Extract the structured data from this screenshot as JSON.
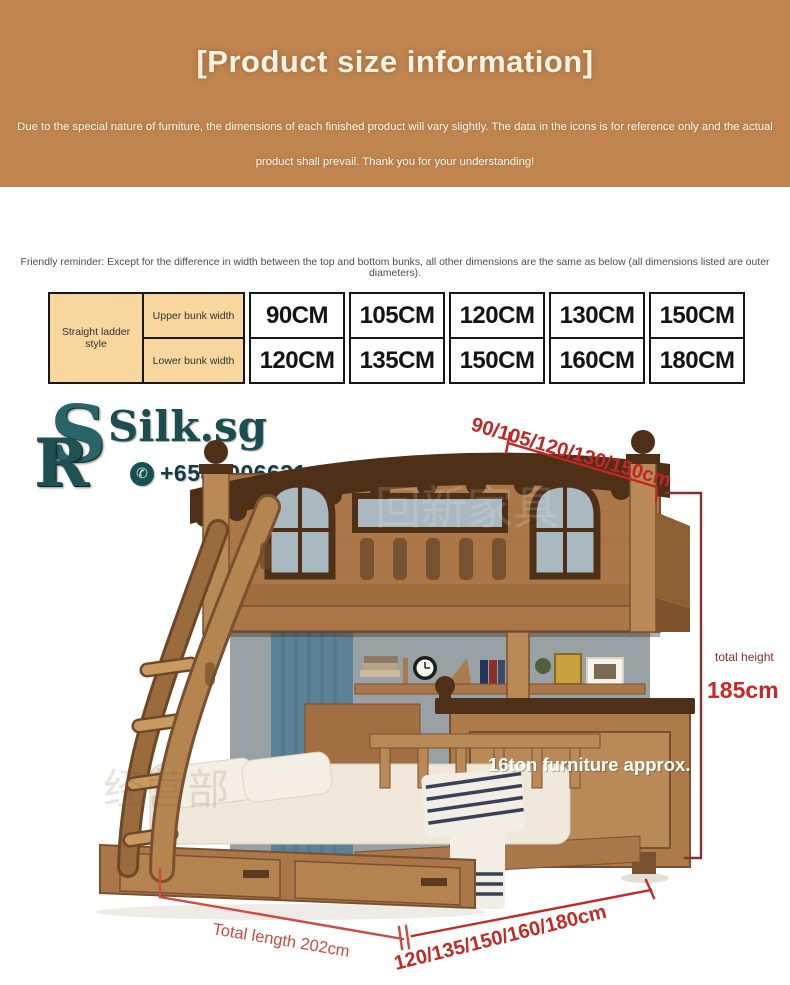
{
  "banner": {
    "title": "[Product size information]",
    "disclaimer_line1": "Due to the special nature of furniture, the dimensions of each finished product will vary slightly. The data in the icons is for reference only and the actual",
    "disclaimer_line2": "product shall prevail. Thank you for your understanding!",
    "bg_color": "#c0854f"
  },
  "reminder": {
    "text": "Friendly reminder: Except for the difference in width between the top and bottom bunks, all other dimensions are the same as below (all dimensions listed are outer diameters)."
  },
  "size_table": {
    "style_label": "Straight ladder style",
    "header_bg": "#f8d79e",
    "rows": [
      {
        "label": "Upper bunk width",
        "values": [
          "90CM",
          "105CM",
          "120CM",
          "130CM",
          "150CM"
        ]
      },
      {
        "label": "Lower bunk width",
        "values": [
          "120CM",
          "135CM",
          "150CM",
          "160CM",
          "180CM"
        ]
      }
    ]
  },
  "logo": {
    "monogram_s": "S",
    "monogram_r": "R",
    "name": "Silk.sg",
    "phone": "+6589006631",
    "whatsapp_glyph": "✆",
    "teal": "#1b4e50"
  },
  "annotations": {
    "top_width": "90/105/120/130/150cm",
    "height_label": "total height",
    "height_value": "185cm",
    "weight_note": "16ton furniture approx.",
    "total_length": "Total length 202cm",
    "bottom_width": "120/135/150/160/180cm",
    "red": "#c42525",
    "dark_red": "#8b2f2f",
    "soft_red": "#cf4b42"
  },
  "watermarks": {
    "wm1": "回新家具",
    "wm2": "经营部"
  },
  "colors": {
    "wood": "#ab7748",
    "wood_light": "#b98a57",
    "wood_dark": "#7a5130",
    "trim_dark": "#4e3019",
    "wall_gray": "#9aa1a5",
    "curtain": "#5d8196"
  }
}
